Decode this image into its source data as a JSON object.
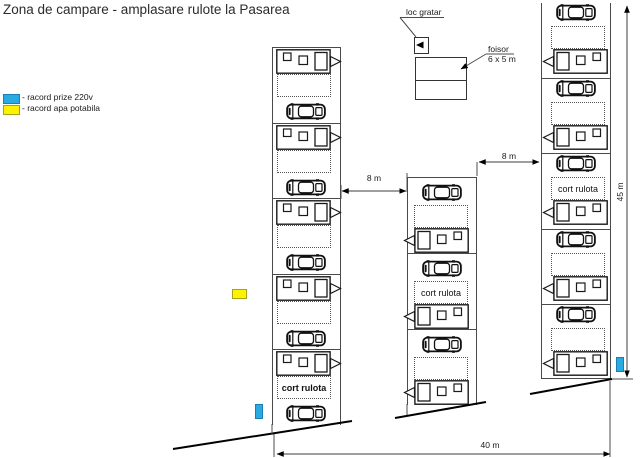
{
  "title": "Zona de campare - amplasare rulote la Pasarea",
  "legend": {
    "power_label": "- racord prize 220v",
    "water_label": "- racord apa potabila"
  },
  "labels": {
    "grill": "loc gratar",
    "gazebo": "foisor",
    "gazebo_size": "6 x 5 m"
  },
  "dimensions": {
    "gap_left_columns": "8 m",
    "gap_right_columns": "8 m",
    "site_depth": "45 m",
    "site_width": "40 m"
  },
  "colors": {
    "power": "#29ABE2",
    "water": "#FFF200"
  },
  "columns": [
    {
      "id": "left",
      "hitch": "right",
      "cells": [
        {
          "tent_label": ""
        },
        {
          "tent_label": ""
        },
        {
          "tent_label": ""
        },
        {
          "tent_label": ""
        },
        {
          "tent_label": "cort rulota",
          "bold": true
        }
      ]
    },
    {
      "id": "middle",
      "hitch": "left",
      "cells": [
        {
          "tent_label": ""
        },
        {
          "tent_label": "cort rulota"
        },
        {
          "tent_label": ""
        }
      ]
    },
    {
      "id": "right",
      "hitch": "left",
      "cells": [
        {
          "tent_label": ""
        },
        {
          "tent_label": ""
        },
        {
          "tent_label": "cort rulota"
        },
        {
          "tent_label": ""
        },
        {
          "tent_label": ""
        }
      ]
    }
  ]
}
